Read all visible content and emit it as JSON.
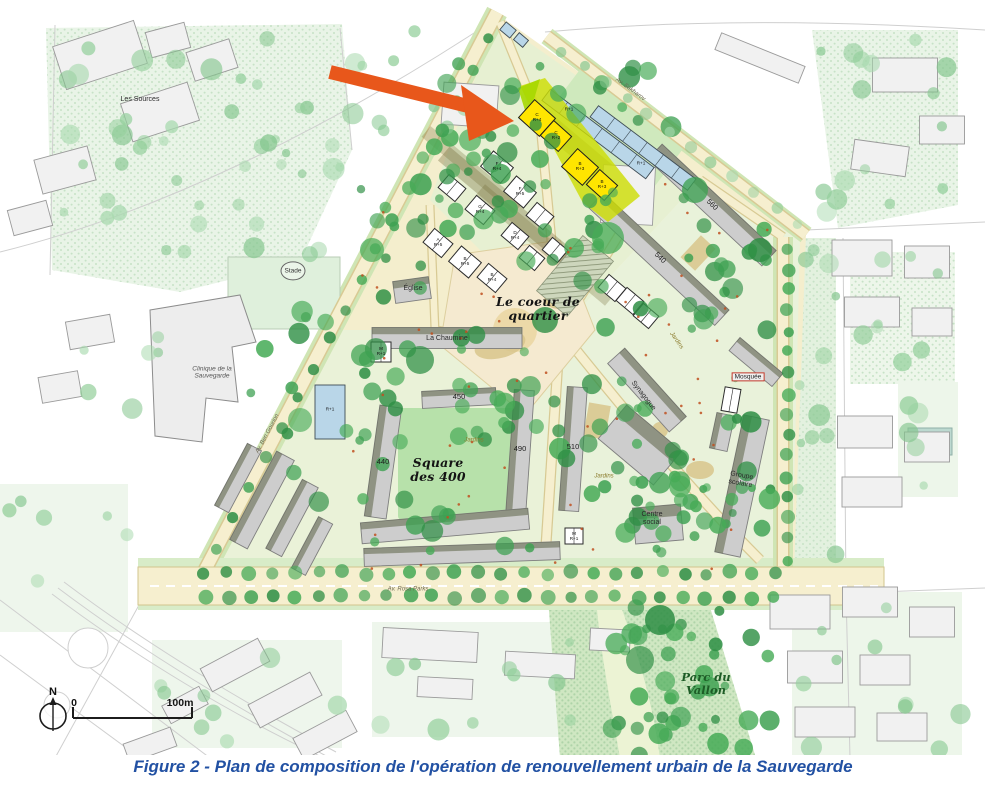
{
  "figure_caption": "Figure 2 - Plan de composition de l'opération de renouvellement urbain de la Sauvegarde",
  "map": {
    "arrow": {
      "color": "#E8571B",
      "meaning": "annotation arrow pointing to highlighted buildings"
    },
    "highlight_color": "#FFE500",
    "scale": {
      "north": "N",
      "zero": "0",
      "hundred": "100m"
    },
    "labels": [
      {
        "name": "les-sources",
        "text": "Les Sources",
        "x": 140,
        "y": 100,
        "cls": "tiny"
      },
      {
        "name": "stade",
        "text": "Stade",
        "x": 293,
        "y": 271,
        "cls": "tiny-circle"
      },
      {
        "name": "clinique",
        "text": "Clinique de la\nSauvegarde",
        "x": 212,
        "y": 373,
        "cls": "italic-tiny"
      },
      {
        "name": "eglise",
        "text": "Église",
        "x": 413,
        "y": 289,
        "cls": "tiny"
      },
      {
        "name": "la-chaumine",
        "text": "La Chaumine",
        "x": 447,
        "y": 339,
        "cls": "tiny"
      },
      {
        "name": "coeur-quartier",
        "text": "Le coeur de\nquartier",
        "x": 538,
        "y": 309,
        "cls": "hand"
      },
      {
        "name": "square-400",
        "text": "Square\ndes 400",
        "x": 438,
        "y": 470,
        "cls": "hand"
      },
      {
        "name": "jardins-1",
        "text": "Jardins",
        "x": 474,
        "y": 441,
        "cls": "jardins"
      },
      {
        "name": "jardins-2",
        "text": "Jardins",
        "x": 604,
        "y": 477,
        "cls": "jardins"
      },
      {
        "name": "jardins-3",
        "text": "Jardins",
        "x": 676,
        "y": 341,
        "cls": "jardins",
        "rot": 55
      },
      {
        "name": "synagogue",
        "text": "Synagogue",
        "x": 643,
        "y": 396,
        "cls": "tiny",
        "rot": 52
      },
      {
        "name": "mosquee",
        "text": "Mosquée",
        "x": 748,
        "y": 377,
        "cls": "mosque"
      },
      {
        "name": "centre-social",
        "text": "Centre\nsocial",
        "x": 652,
        "y": 519,
        "cls": "tiny"
      },
      {
        "name": "groupe-scolaire",
        "text": "Groupe\nscolaire",
        "x": 741,
        "y": 480,
        "cls": "tiny",
        "rot": 10
      },
      {
        "name": "parc-du-vallon",
        "text": "Parc du\nVallon",
        "x": 706,
        "y": 684,
        "cls": "hand-green"
      },
      {
        "name": "num-440",
        "text": "440",
        "x": 383,
        "y": 462,
        "cls": "num"
      },
      {
        "name": "num-450",
        "text": "450",
        "x": 459,
        "y": 397,
        "cls": "num"
      },
      {
        "name": "num-490",
        "text": "490",
        "x": 520,
        "y": 449,
        "cls": "num"
      },
      {
        "name": "num-510",
        "text": "510",
        "x": 573,
        "y": 447,
        "cls": "num"
      },
      {
        "name": "num-560",
        "text": "560",
        "x": 712,
        "y": 205,
        "cls": "num",
        "rot": 43
      },
      {
        "name": "num-540",
        "text": "540",
        "x": 660,
        "y": 258,
        "cls": "num",
        "rot": 43
      },
      {
        "name": "street-ben-gourion",
        "text": "Av. Ben Gourion",
        "x": 268,
        "y": 434,
        "cls": "street",
        "rot": -62
      },
      {
        "name": "street-rosa-parks",
        "text": "Av. Rosa Parks",
        "x": 408,
        "y": 590,
        "cls": "street"
      },
      {
        "name": "street-sakharov",
        "text": "Av. Sakharov",
        "x": 630,
        "y": 90,
        "cls": "street",
        "rot": 36
      },
      {
        "name": "code-blue-1",
        "text": "R+1",
        "x": 569,
        "y": 110,
        "cls": "code"
      },
      {
        "name": "code-blue-2",
        "text": "R+1",
        "x": 641,
        "y": 164,
        "cls": "code"
      },
      {
        "name": "code-blue-tower",
        "text": "R+1",
        "x": 330,
        "y": 410,
        "cls": "code"
      },
      {
        "name": "code-yellow-1",
        "text": "C\nR+4",
        "x": 537,
        "y": 118,
        "cls": "code"
      },
      {
        "name": "code-yellow-2",
        "text": "C\nR+2",
        "x": 556,
        "y": 136,
        "cls": "code"
      },
      {
        "name": "code-yellow-3",
        "text": "B\nR+3",
        "x": 580,
        "y": 167,
        "cls": "code"
      },
      {
        "name": "code-yellow-4",
        "text": "B\nR+3",
        "x": 602,
        "y": 185,
        "cls": "code"
      },
      {
        "name": "code-white-1",
        "text": "F\nR+4",
        "x": 497,
        "y": 167,
        "cls": "code"
      },
      {
        "name": "code-white-2",
        "text": "F\nR+5",
        "x": 520,
        "y": 192,
        "cls": "code"
      },
      {
        "name": "code-white-3",
        "text": "G\nR+4",
        "x": 480,
        "y": 210,
        "cls": "code"
      },
      {
        "name": "code-white-4",
        "text": "A\nR+5",
        "x": 438,
        "y": 243,
        "cls": "code"
      },
      {
        "name": "code-white-5",
        "text": "B\nR+5",
        "x": 465,
        "y": 262,
        "cls": "code"
      },
      {
        "name": "code-white-6",
        "text": "B\nR+4",
        "x": 492,
        "y": 278,
        "cls": "code"
      },
      {
        "name": "code-white-7",
        "text": "D\nR+4",
        "x": 515,
        "y": 236,
        "cls": "code"
      },
      {
        "name": "code-white-8",
        "text": "M\nR+1",
        "x": 381,
        "y": 352,
        "cls": "code"
      },
      {
        "name": "code-white-9",
        "text": "M\nR+1",
        "x": 574,
        "y": 537,
        "cls": "code"
      }
    ]
  }
}
